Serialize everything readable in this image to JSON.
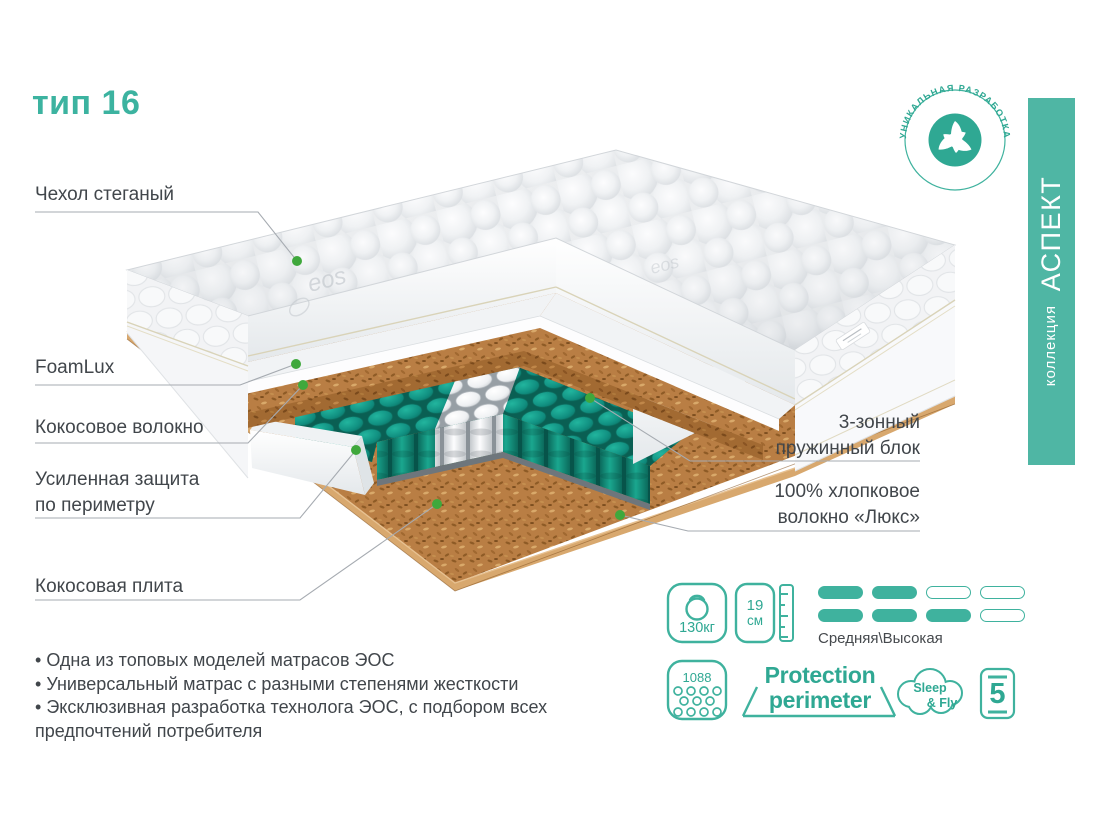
{
  "title": "тип 16",
  "badge": {
    "arc_text": "УНИКАЛЬНАЯ РАЗРАБОТКА"
  },
  "collection": {
    "prefix": "коллекция",
    "name": "АСПЕКТ"
  },
  "callouts": {
    "cover": "Чехол стеганый",
    "foam": "FoamLux",
    "coconut_fiber": "Кокосовое волокно",
    "perimeter_line1": "Усиленная защита",
    "perimeter_line2": "по периметру",
    "coconut_plate": "Кокосовая плита",
    "springs_line1": "3-зонный",
    "springs_line2": "пружинный блок",
    "cotton_line1": "100% хлопковое",
    "cotton_line2": "волокно «Люкс»"
  },
  "features": [
    "Одна из топовых моделей матрасов ЭОС",
    "Универсальный матрас с разными степенями жесткости",
    "Эксклюзивная разработка технолога ЭОС, с подбором всех предпочтений потребителя"
  ],
  "specs": {
    "max_load": "130кг",
    "height_value": "19",
    "height_unit": "см",
    "firmness": "Средняя\\Высокая",
    "springs_count": "1088",
    "protection_line1": "Protection",
    "protection_line2": "perimeter",
    "brand_line1": "Sleep",
    "brand_line2": "& Fly",
    "warranty_years": "5"
  },
  "fabric_logo": "eos",
  "colors": {
    "accent": "#2FA893",
    "green_dot": "#3FA83C",
    "spring_teal": "#0F8F7D",
    "coconut": "#B97E44",
    "collection_bar": "#4FB6A4"
  }
}
